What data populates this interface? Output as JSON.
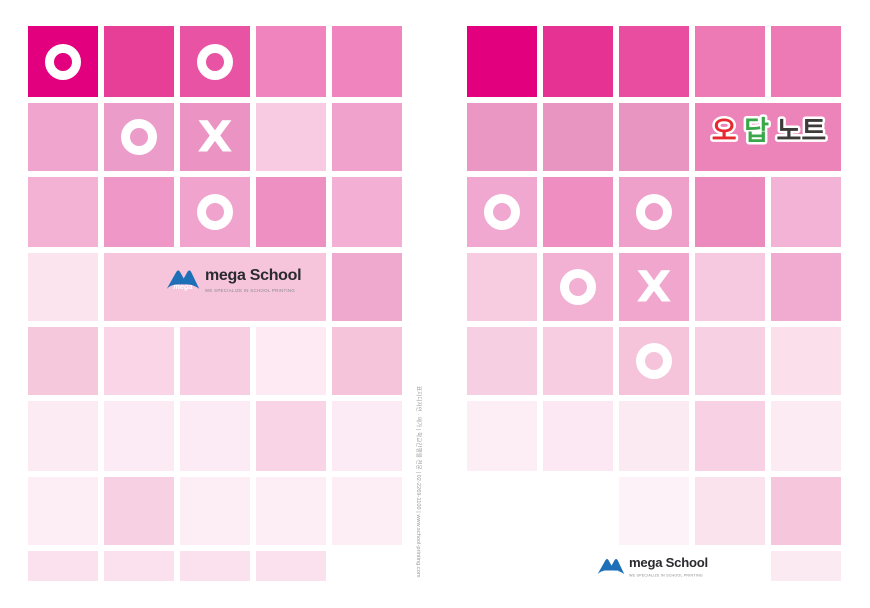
{
  "page": {
    "background": "#ffffff"
  },
  "symbols": {
    "o": "O",
    "x": "X"
  },
  "title_label": {
    "part_red": "오",
    "part_green": "답",
    "part_dark": "노트",
    "color_red": "#e7282f",
    "color_green": "#3aa84a",
    "color_dark": "#3e3a39",
    "outline_color": "#ffffff"
  },
  "logo": {
    "icon_text": "mega",
    "name": "mega School",
    "tagline": "WE SPECIALIZE IN SCHOOL PRINTING",
    "icon_color": "#1d70b7",
    "text_color": "#2a2a31"
  },
  "spine": {
    "text": "표지디자인 · 메가 | 학교간행물 전문 | 02-2269-1100 | www.school-printing.com"
  },
  "grid": {
    "back": {
      "x": 28,
      "cells": [
        {
          "r": 1,
          "c": 1,
          "color": "#e3007f",
          "sym": "O"
        },
        {
          "r": 1,
          "c": 2,
          "color": "#e73e97"
        },
        {
          "r": 1,
          "c": 3,
          "color": "#e854a3",
          "sym": "O"
        },
        {
          "r": 1,
          "c": 4,
          "color": "#ef84bf"
        },
        {
          "r": 1,
          "c": 5,
          "color": "#ef84bf"
        },
        {
          "r": 2,
          "c": 1,
          "color": "#f0a5ce"
        },
        {
          "r": 2,
          "c": 2,
          "color": "#ec9cc8",
          "sym": "O"
        },
        {
          "r": 2,
          "c": 3,
          "color": "#eb94c3",
          "sym": "X"
        },
        {
          "r": 2,
          "c": 4,
          "color": "#f8cbe2"
        },
        {
          "r": 2,
          "c": 5,
          "color": "#f0a2cc"
        },
        {
          "r": 3,
          "c": 1,
          "color": "#f3b1d4"
        },
        {
          "r": 3,
          "c": 2,
          "color": "#ef97c6"
        },
        {
          "r": 3,
          "c": 3,
          "color": "#f0a3cc",
          "sym": "O"
        },
        {
          "r": 3,
          "c": 4,
          "color": "#ee90c2"
        },
        {
          "r": 3,
          "c": 5,
          "color": "#f3b0d4"
        },
        {
          "r": 4,
          "c": 1,
          "color": "#fce4ef"
        },
        {
          "r": 4,
          "c": 2,
          "span": 3,
          "color": "#f6c5dc"
        },
        {
          "r": 4,
          "c": 5,
          "color": "#f0a9ce"
        },
        {
          "r": 5,
          "c": 1,
          "color": "#f6c8dc"
        },
        {
          "r": 5,
          "c": 2,
          "color": "#fad5e7"
        },
        {
          "r": 5,
          "c": 3,
          "color": "#f8cfe2"
        },
        {
          "r": 5,
          "c": 4,
          "color": "#fdeaf3"
        },
        {
          "r": 5,
          "c": 5,
          "color": "#f5c3da"
        },
        {
          "r": 6,
          "c": 1,
          "color": "#fdebf4"
        },
        {
          "r": 6,
          "c": 2,
          "color": "#fcebf4"
        },
        {
          "r": 6,
          "c": 3,
          "color": "#fcebf4"
        },
        {
          "r": 6,
          "c": 4,
          "color": "#f9d4e6"
        },
        {
          "r": 6,
          "c": 5,
          "color": "#fcebf4"
        },
        {
          "r": 7,
          "c": 1,
          "color": "#fdeef6"
        },
        {
          "r": 7,
          "c": 2,
          "color": "#f8d0e3"
        },
        {
          "r": 7,
          "c": 3,
          "color": "#fdeef6"
        },
        {
          "r": 7,
          "c": 4,
          "color": "#fdeef6"
        },
        {
          "r": 7,
          "c": 5,
          "color": "#fdeef6"
        },
        {
          "r": 8,
          "c": 1,
          "color": "#fbe1ed"
        },
        {
          "r": 8,
          "c": 2,
          "color": "#fbe1ed"
        },
        {
          "r": 8,
          "c": 3,
          "color": "#fbe1ed"
        },
        {
          "r": 8,
          "c": 4,
          "color": "#fbe1ed"
        }
      ]
    },
    "front": {
      "x": 467,
      "cells": [
        {
          "r": 1,
          "c": 1,
          "color": "#e2007f"
        },
        {
          "r": 1,
          "c": 2,
          "color": "#e63293"
        },
        {
          "r": 1,
          "c": 3,
          "color": "#e84da0"
        },
        {
          "r": 1,
          "c": 4,
          "color": "#ed79b5"
        },
        {
          "r": 1,
          "c": 5,
          "color": "#ed79b5"
        },
        {
          "r": 2,
          "c": 1,
          "color": "#ea97c3"
        },
        {
          "r": 2,
          "c": 2,
          "color": "#e995c1"
        },
        {
          "r": 2,
          "c": 3,
          "color": "#e995c1"
        },
        {
          "r": 2,
          "c": 4,
          "span": 2,
          "color": "#ec84b9"
        },
        {
          "r": 3,
          "c": 1,
          "color": "#f0a8d0",
          "sym": "O"
        },
        {
          "r": 3,
          "c": 2,
          "color": "#ee8ec1"
        },
        {
          "r": 3,
          "c": 3,
          "color": "#efa0ca",
          "sym": "O"
        },
        {
          "r": 3,
          "c": 4,
          "color": "#ec8abd"
        },
        {
          "r": 3,
          "c": 5,
          "color": "#f3b3d6"
        },
        {
          "r": 4,
          "c": 1,
          "color": "#f7cce1"
        },
        {
          "r": 4,
          "c": 2,
          "color": "#f2b0d3",
          "sym": "O"
        },
        {
          "r": 4,
          "c": 3,
          "color": "#f0a6cd",
          "sym": "X"
        },
        {
          "r": 4,
          "c": 4,
          "color": "#f7c9e0"
        },
        {
          "r": 4,
          "c": 5,
          "color": "#f1aad0"
        },
        {
          "r": 5,
          "c": 1,
          "color": "#f7cfe2"
        },
        {
          "r": 5,
          "c": 2,
          "color": "#f7cde1"
        },
        {
          "r": 5,
          "c": 3,
          "color": "#f5c4db",
          "sym": "O"
        },
        {
          "r": 5,
          "c": 4,
          "color": "#f8d0e3"
        },
        {
          "r": 5,
          "c": 5,
          "color": "#fbdfeb"
        },
        {
          "r": 6,
          "c": 1,
          "color": "#fdeef6"
        },
        {
          "r": 6,
          "c": 2,
          "color": "#fce8f2"
        },
        {
          "r": 6,
          "c": 3,
          "color": "#fceaf3"
        },
        {
          "r": 6,
          "c": 4,
          "color": "#f8d2e4"
        },
        {
          "r": 6,
          "c": 5,
          "color": "#fcebf3"
        },
        {
          "r": 7,
          "c": 3,
          "color": "#fdf2f8"
        },
        {
          "r": 7,
          "c": 4,
          "color": "#fbe3ee"
        },
        {
          "r": 7,
          "c": 5,
          "color": "#f5c6dc"
        },
        {
          "r": 8,
          "c": 5,
          "color": "#fceaf3"
        }
      ]
    }
  }
}
